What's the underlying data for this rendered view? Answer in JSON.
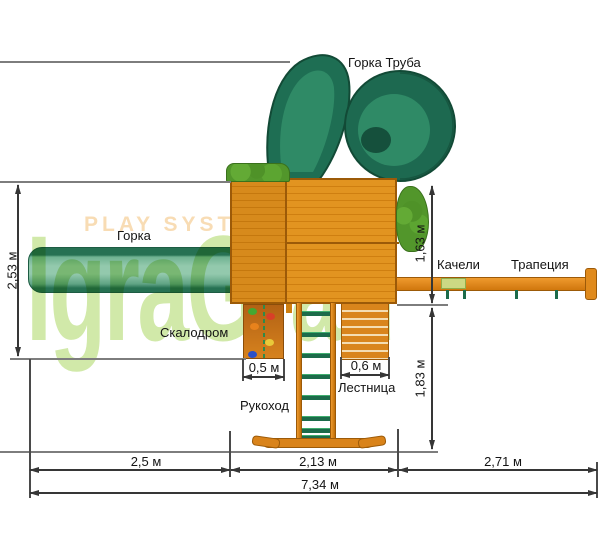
{
  "watermark": {
    "brand": "IgraGrad",
    "slogan": "PLAY SYSTEM"
  },
  "labels": {
    "tube_slide": "Горка Труба",
    "slide": "Горка",
    "climbing_wall": "Скалодром",
    "monkey_bars": "Рукоход",
    "ladder": "Лестница",
    "swing": "Качели",
    "trapeze": "Трапеция"
  },
  "dimensions": {
    "depth_total": "2,53 м",
    "right_upper": "1,63 м",
    "right_lower": "1,83 м",
    "climbing_wall_width": "0,5 м",
    "ladder_width": "0,6 м",
    "slide_span": "2,5 м",
    "tower_span": "2,13 м",
    "swing_span": "2,71 м",
    "total_length": "7,34 м"
  },
  "colors": {
    "wood": "#df8f1e",
    "wood_dark": "#9c5a08",
    "slide_green": "#2f8a66",
    "tube_green_dark": "#1d6950",
    "bush_green": "#52962b",
    "beam_orange": "#dd8316",
    "watermark_green": "#c9e59a",
    "watermark_tan": "#f8dcb4",
    "dimension_line": "#363636",
    "reference_line": "#7d7d7d"
  }
}
